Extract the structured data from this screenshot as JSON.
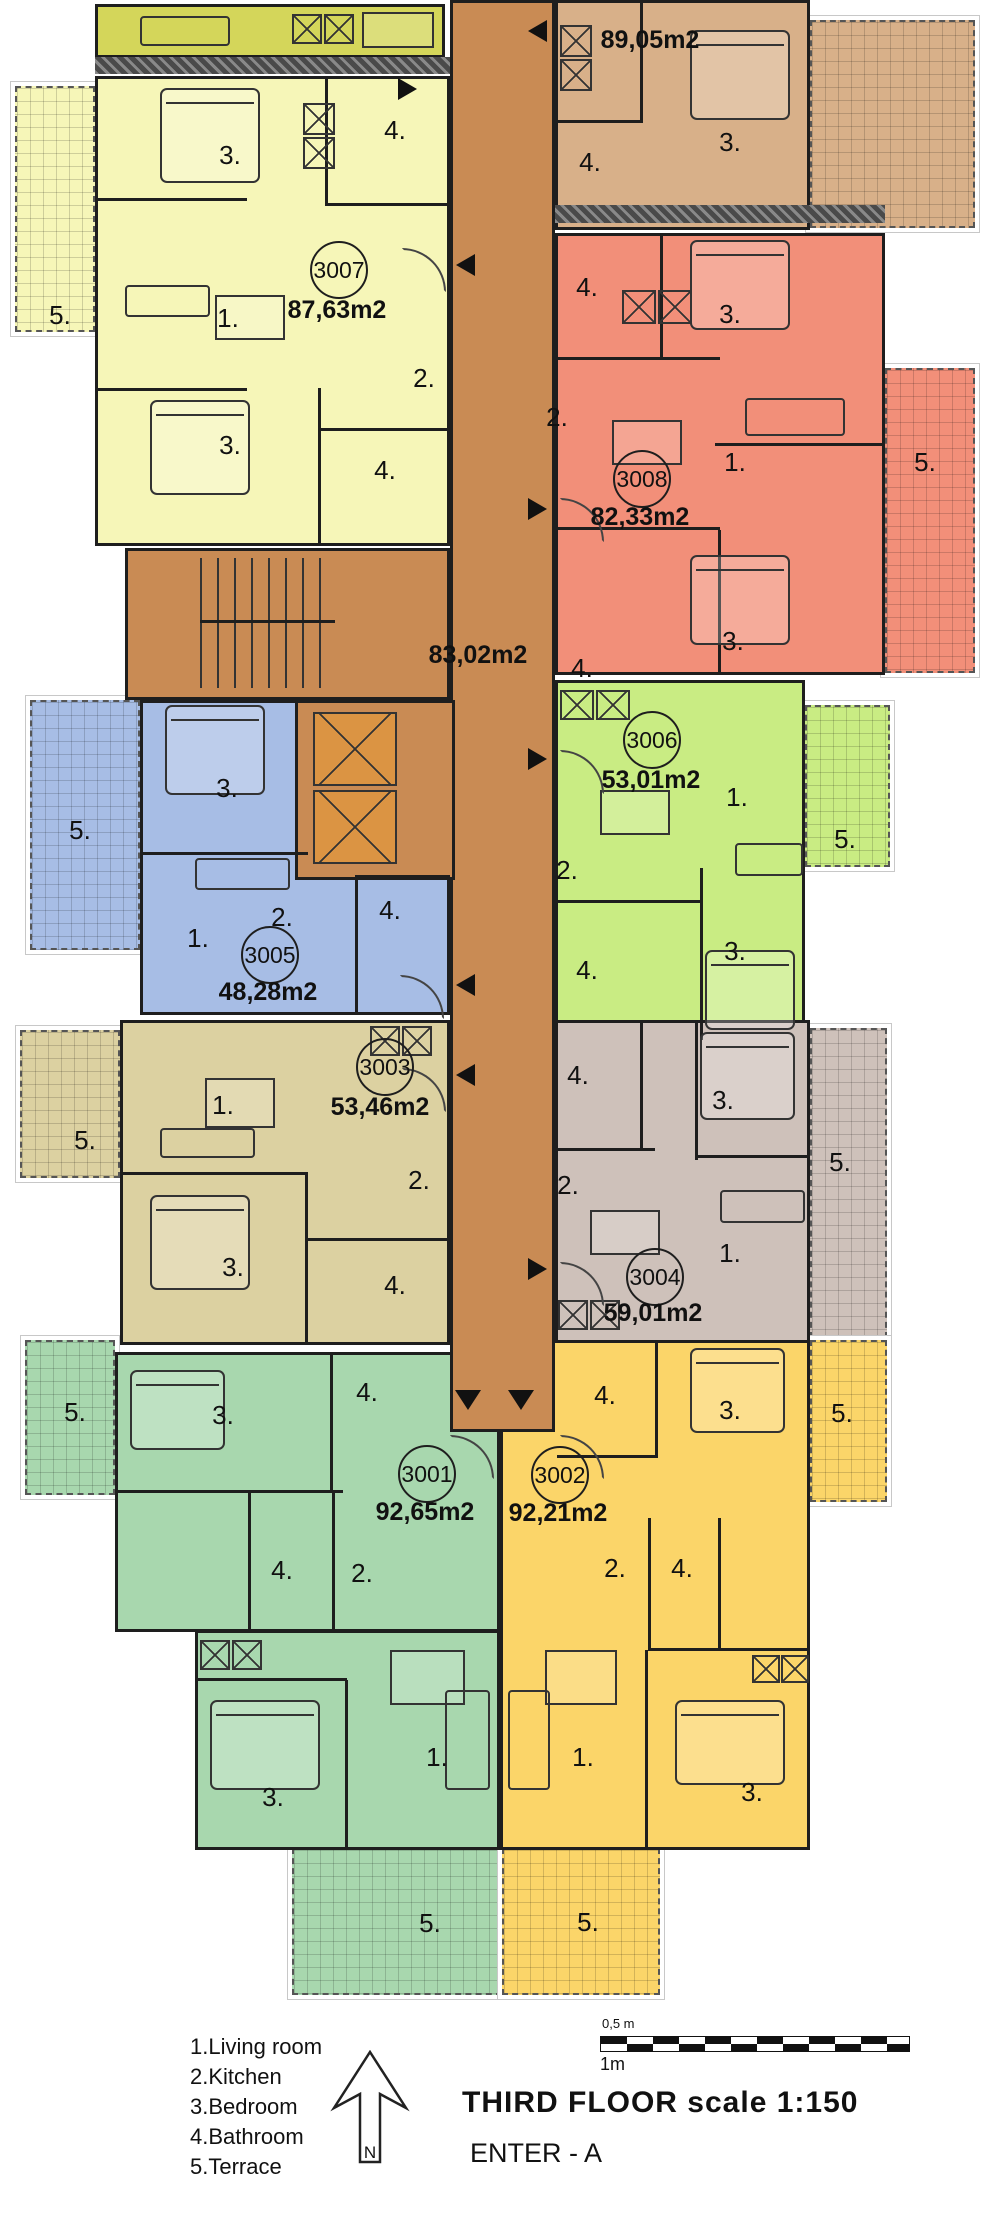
{
  "title": {
    "main": "THIRD FLOOR scale 1:150",
    "enter": "ENTER - A"
  },
  "north_label": "N",
  "scale_bar": {
    "top": "0,5 m",
    "bottom": "1m"
  },
  "legend": [
    "1.Living room",
    "2.Kitchen",
    "3.Bedroom",
    "4.Bathroom",
    "5.Terrace"
  ],
  "corridor": {
    "area": "83,02m2"
  },
  "rooms": {
    "living": "1.",
    "kitchen": "2.",
    "bedroom": "3.",
    "bathroom": "4.",
    "terrace": "5."
  },
  "apartments": [
    {
      "id": "3007",
      "area": "87,63m2"
    },
    {
      "id": "",
      "area": "89,05m2"
    },
    {
      "id": "3008",
      "area": "82,33m2"
    },
    {
      "id": "3006",
      "area": "53,01m2"
    },
    {
      "id": "3005",
      "area": "48,28m2"
    },
    {
      "id": "3003",
      "area": "53,46m2"
    },
    {
      "id": "3004",
      "area": "59,01m2"
    },
    {
      "id": "3001",
      "area": "92,65m2"
    },
    {
      "id": "3002",
      "area": "92,21m2"
    }
  ],
  "colors": {
    "apt_3007": "#f6f6b8",
    "apt_top_right": "#d8b089",
    "apt_3008": "#f28f79",
    "apt_3006": "#c9ec83",
    "apt_3005": "#a7bde5",
    "apt_3003": "#dcd1a1",
    "apt_3004": "#cec1ba",
    "apt_3001": "#a8d7ae",
    "apt_3002": "#fbd569",
    "corridor": "#c98b54",
    "elevator": "#db9443",
    "olive_strip": "#d4d65a",
    "wall": "#1e1e1e"
  }
}
